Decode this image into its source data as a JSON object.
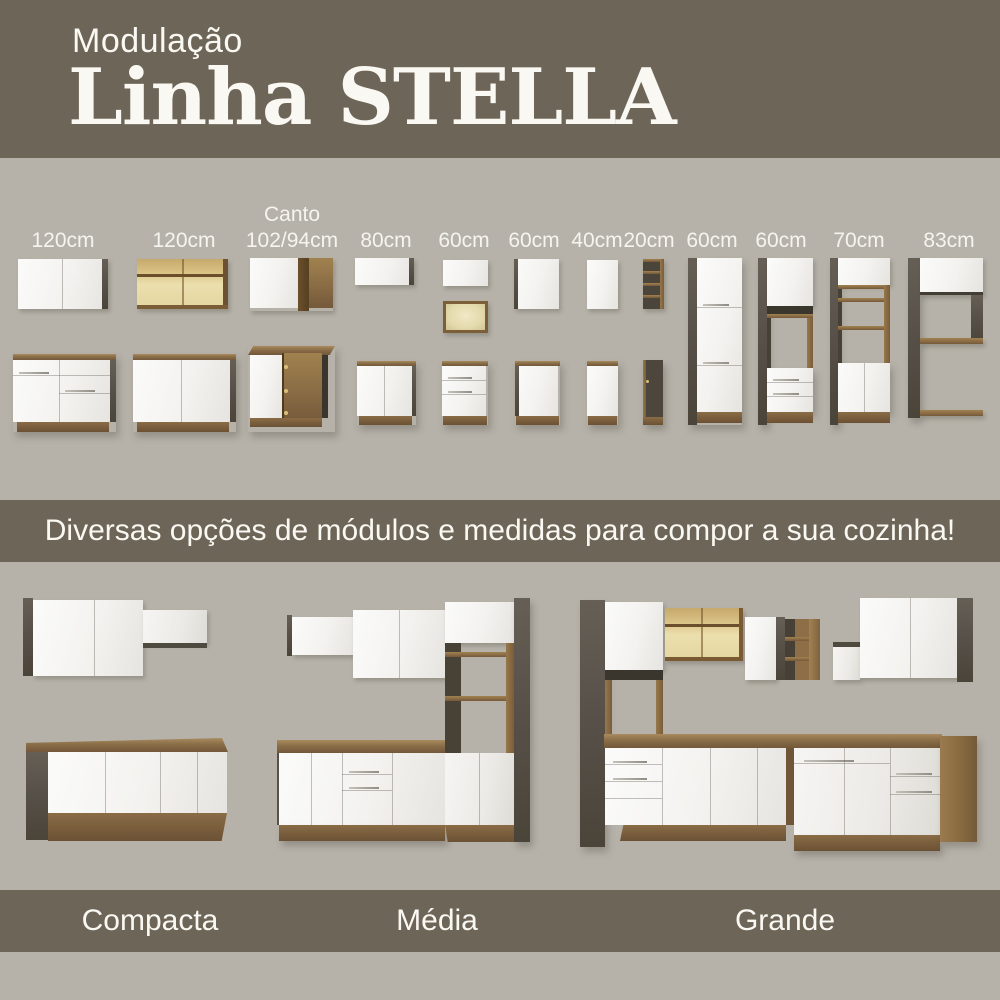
{
  "header": {
    "subtitle": "Modulação",
    "title": "Linha STELLA"
  },
  "modules": {
    "labels": [
      {
        "top": "",
        "size": "120cm"
      },
      {
        "top": "",
        "size": "120cm"
      },
      {
        "top": "Canto",
        "size": "102/94cm"
      },
      {
        "top": "",
        "size": "80cm"
      },
      {
        "top": "",
        "size": "60cm"
      },
      {
        "top": "",
        "size": "60cm"
      },
      {
        "top": "",
        "size": "40cm"
      },
      {
        "top": "",
        "size": "20cm"
      },
      {
        "top": "",
        "size": "60cm"
      },
      {
        "top": "",
        "size": "60cm"
      },
      {
        "top": "",
        "size": "70cm"
      },
      {
        "top": "",
        "size": "83cm"
      }
    ]
  },
  "banner": {
    "text": "Diversas opções de módulos e medidas para compor a sua cozinha!"
  },
  "kitchens": {
    "labels": [
      "Compacta",
      "Média",
      "Grande"
    ]
  },
  "colors": {
    "band": "#6d6558",
    "background": "#b6b2a9",
    "wood": "#8a6c45",
    "cabinet_white": "#f3f2ef"
  }
}
